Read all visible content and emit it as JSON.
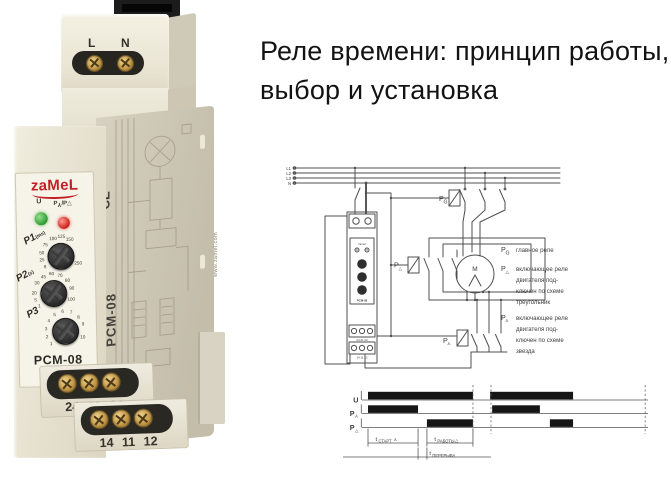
{
  "title": {
    "line1": "Реле времени: принцип работы,",
    "line2": "выбор и установка"
  },
  "symbols": {
    "star_base": "Y",
    "delta": "△",
    "main": "G"
  },
  "device": {
    "brand": "zaMeL",
    "model": "PCM-08",
    "top_terminals": [
      "L",
      "N"
    ],
    "led_u_label": "U",
    "led_mode_parts": {
      "p1": "P",
      "p2": "/P"
    },
    "knobs": [
      {
        "label": "P1",
        "unit": "(ms)",
        "scale": [
          {
            "v": "8",
            "a": -125
          },
          {
            "v": "25",
            "a": -102
          },
          {
            "v": "50",
            "a": -79
          },
          {
            "v": "75",
            "a": -52
          },
          {
            "v": "100",
            "a": -22
          },
          {
            "v": "125",
            "a": 4
          },
          {
            "v": "150",
            "a": 30
          },
          {
            "v": "250",
            "a": 113
          }
        ]
      },
      {
        "label": "P2",
        "unit": "(s)",
        "scale": [
          {
            "v": "1",
            "a": -132
          },
          {
            "v": "5",
            "a": -110
          },
          {
            "v": "20",
            "a": -88
          },
          {
            "v": "30",
            "a": -58
          },
          {
            "v": "45",
            "a": -30
          },
          {
            "v": "60",
            "a": -4
          },
          {
            "v": "70",
            "a": 22
          },
          {
            "v": "80",
            "a": 50
          },
          {
            "v": "90",
            "a": 78
          },
          {
            "v": "100",
            "a": 110
          }
        ]
      },
      {
        "label": "P3",
        "unit": "",
        "scale": [
          {
            "v": "1",
            "a": -132
          },
          {
            "v": "2",
            "a": -108
          },
          {
            "v": "3",
            "a": -84
          },
          {
            "v": "4",
            "a": -58
          },
          {
            "v": "5",
            "a": -32
          },
          {
            "v": "6",
            "a": -6
          },
          {
            "v": "7",
            "a": 20
          },
          {
            "v": "8",
            "a": 46
          },
          {
            "v": "9",
            "a": 72
          },
          {
            "v": "10",
            "a": 112
          }
        ]
      }
    ],
    "terminals_row1": [
      "24",
      "21",
      "22"
    ],
    "terminals_row2": [
      "14",
      "11",
      "12"
    ],
    "side": {
      "model": "PCM-08",
      "ce": "CE",
      "url": "www.zamel.com"
    }
  },
  "schematic": {
    "bus": [
      "L1",
      "L2",
      "L3",
      "N"
    ],
    "motor": "M",
    "mini": {
      "brand": "zamel",
      "model": "PCM-08",
      "t1": "24 21 22",
      "t2": "14 11 12"
    },
    "legend": [
      {
        "sub": "main",
        "lines": [
          "главное реле"
        ]
      },
      {
        "sub": "delta",
        "lines": [
          "включающее реле",
          "двигателя под-",
          "ключен по схеме",
          "треугольник"
        ]
      },
      {
        "sub": "star",
        "lines": [
          "включающее реле",
          "двигателя под-",
          "ключен по схеме",
          "звезда"
        ]
      }
    ]
  },
  "timing_diagram": {
    "type": "timing",
    "rows": [
      {
        "base": "U",
        "sub": null,
        "bars": [
          [
            0.021,
            0.388
          ],
          [
            0.448,
            0.738
          ]
        ]
      },
      {
        "base": "P",
        "sub": "star",
        "bars": [
          [
            0.021,
            0.196
          ],
          [
            0.455,
            0.622
          ]
        ]
      },
      {
        "base": "P",
        "sub": "delta",
        "bars": [
          [
            0.227,
            0.388
          ],
          [
            0.657,
            0.738
          ]
        ]
      }
    ],
    "dashed_x": [
      0.388,
      0.451,
      0.99
    ],
    "annotations": [
      {
        "t": "t",
        "sub": "СТАРТ",
        "sym": "star",
        "from": 0.021,
        "to": 0.196,
        "level": 1
      },
      {
        "t": "t",
        "sub": "РАБОТЫ",
        "sym": "delta",
        "from": 0.227,
        "to": 0.388,
        "level": 1
      },
      {
        "t": "t",
        "sub": "ПЕРЕРЫВА",
        "sym": null,
        "from": 0.196,
        "to": 0.227,
        "level": 2
      }
    ]
  },
  "colors": {
    "brand_red": "#c22027",
    "led_green": "#3fa83f",
    "led_red": "#d2281e",
    "ink": "#2c2a25",
    "line": "#4f4f4f"
  }
}
